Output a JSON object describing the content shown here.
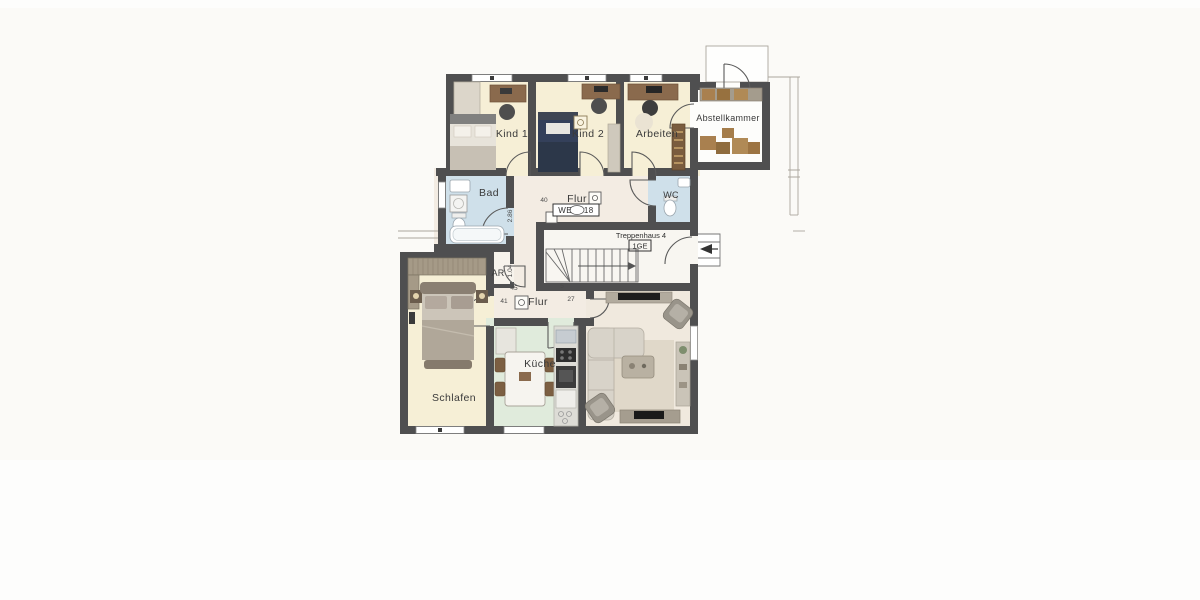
{
  "plan": {
    "unit_badge": "WE 18",
    "floor_badge": "1GE",
    "rooms": {
      "kind1": "Kind 1",
      "kind2": "Kind 2",
      "arbeiten": "Arbeiten",
      "abstellkammer": "Abstellkammer",
      "bad": "Bad",
      "flur_top": "Flur",
      "wc": "WC",
      "treppenhaus": "Treppenhaus 4",
      "ar": "AR",
      "flur_bottom": "Flur",
      "schlafen": "Schlafen",
      "kueche": "Küche"
    },
    "dimensions": {
      "corridor_depth": "2.86",
      "ar_width": "1.04",
      "top_width": "40",
      "small_a": "45",
      "small_b": "41",
      "small_c": "27",
      "small_d": "5"
    },
    "colors": {
      "wall": "#4f4f50",
      "bedroom_cream": "#f6efd6",
      "bath_blue": "#cfe0ea",
      "kitchen_mint": "#e0ebdc",
      "hall_beige": "#f3ece3",
      "living_beige": "#f0e9de",
      "storage_white": "#fdfdfb",
      "paper": "#fbfaf7"
    }
  }
}
